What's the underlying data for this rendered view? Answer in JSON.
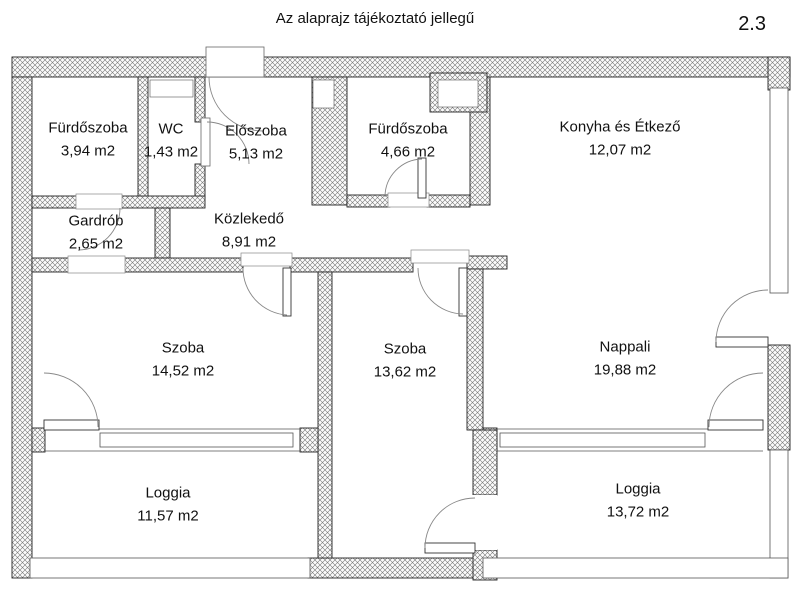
{
  "title": "Az alaprajz tájékoztató jellegű",
  "page_marker": "2.3",
  "rooms": [
    {
      "id": "furdoszoba-1",
      "name": "Fürdőszoba",
      "area": "3,94 m2"
    },
    {
      "id": "wc",
      "name": "WC",
      "area": "1,43 m2"
    },
    {
      "id": "eloszoba",
      "name": "Előszoba",
      "area": "5,13 m2"
    },
    {
      "id": "furdoszoba-2",
      "name": "Fürdőszoba",
      "area": "4,66 m2"
    },
    {
      "id": "konyha-etkezo",
      "name": "Konyha és Étkező",
      "area": "12,07 m2"
    },
    {
      "id": "gardrob",
      "name": "Gardrób",
      "area": "2,65 m2"
    },
    {
      "id": "kozlekedo",
      "name": "Közlekedő",
      "area": "8,91 m2"
    },
    {
      "id": "szoba-1",
      "name": "Szoba",
      "area": "14,52 m2"
    },
    {
      "id": "szoba-2",
      "name": "Szoba",
      "area": "13,62 m2"
    },
    {
      "id": "nappali",
      "name": "Nappali",
      "area": "19,88 m2"
    },
    {
      "id": "loggia-1",
      "name": "Loggia",
      "area": "11,57 m2"
    },
    {
      "id": "loggia-2",
      "name": "Loggia",
      "area": "13,72 m2"
    }
  ]
}
